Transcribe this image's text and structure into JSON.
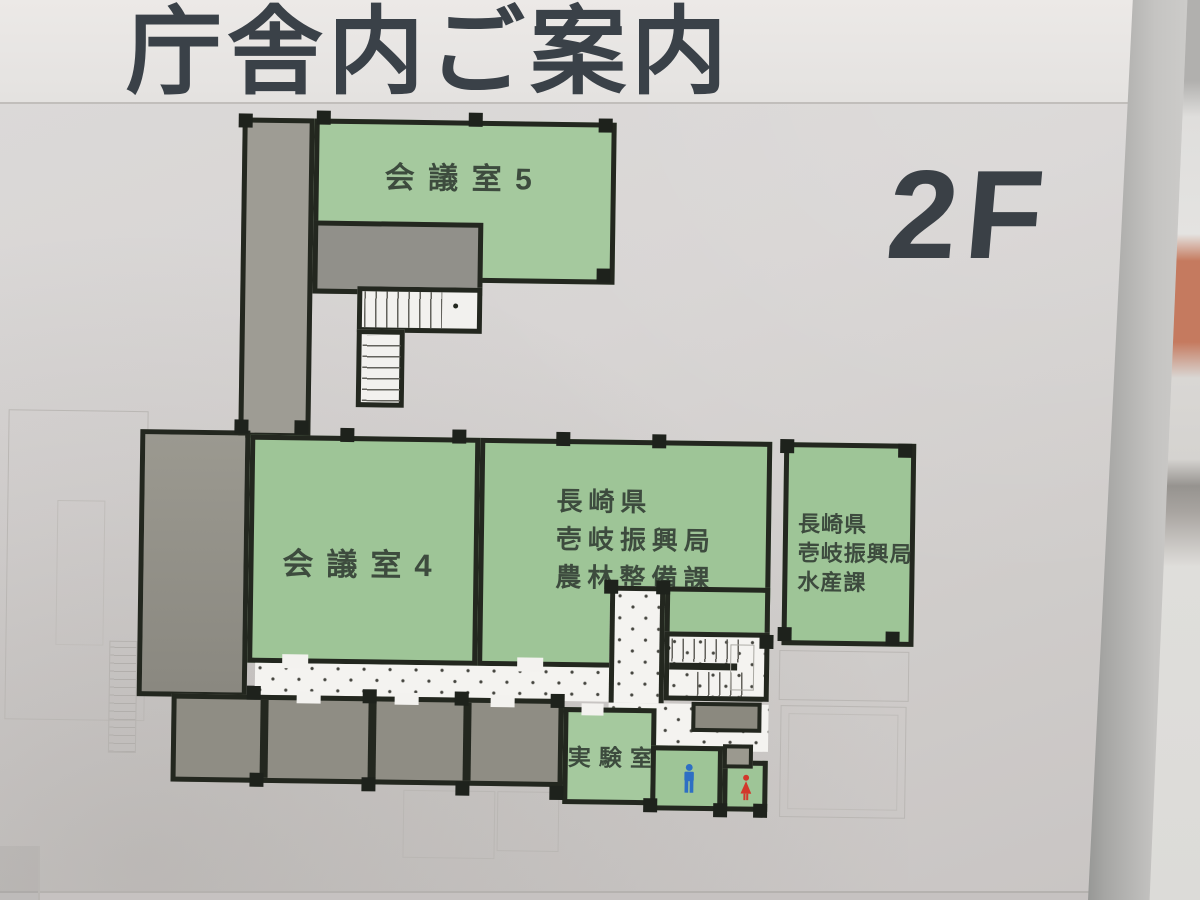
{
  "sign": {
    "title": "庁舎内ご案内",
    "floor_label": "2F"
  },
  "rooms": {
    "meeting5": {
      "label": "会議室5"
    },
    "meeting4": {
      "label": "会議室4"
    },
    "agriculture": {
      "lines": [
        "長崎県",
        "壱岐振興局",
        "農林整備課"
      ]
    },
    "fisheries": {
      "lines": [
        "長崎県",
        "壱岐振興局",
        "水産課"
      ]
    },
    "lab": {
      "label": "実験室"
    }
  },
  "legend": {
    "male_icon": "male-restroom-pictogram",
    "female_icon": "female-restroom-pictogram"
  },
  "colors": {
    "room_green": "#9ec597",
    "service_gray": "#8f8d84",
    "wall": "#23271f",
    "male_blue": "#2e6fc4",
    "female_red": "#d2372b",
    "title_text": "#3a4148",
    "label_text": "#3d4b3e"
  }
}
